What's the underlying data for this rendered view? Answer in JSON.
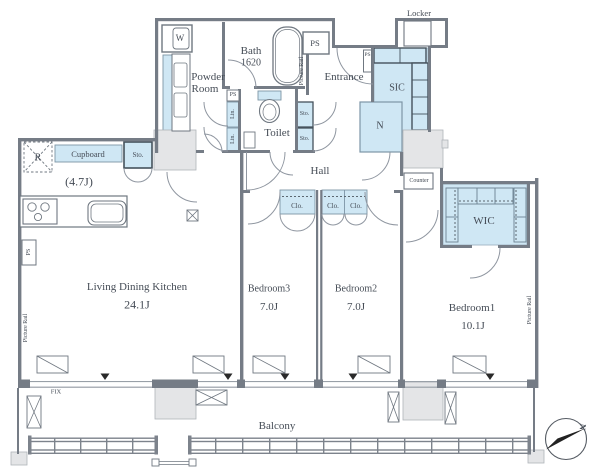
{
  "rooms": {
    "ldk": {
      "name": "Living Dining Kitchen",
      "size": "24.1J"
    },
    "kitchen_size": "(4.7J)",
    "bedroom1": {
      "name": "Bedroom1",
      "size": "10.1J"
    },
    "bedroom2": {
      "name": "Bedroom2",
      "size": "7.0J"
    },
    "bedroom3": {
      "name": "Bedroom3",
      "size": "7.0J"
    },
    "bath": {
      "name": "Bath",
      "size": "1620"
    },
    "powder_room": {
      "line1": "Powder",
      "line2": "Room"
    },
    "toilet": "Toilet",
    "entrance": "Entrance",
    "hall": "Hall",
    "balcony": "Balcony",
    "wic": "WIC",
    "sic": "SIC",
    "locker": "Locker",
    "counter": "Counter",
    "n_storage": "N"
  },
  "fixtures": {
    "washer": "W",
    "fridge": "R",
    "cupboard": "Cupboard",
    "storage": "Sto.",
    "linen": "Lin.",
    "closet": "Clo.",
    "ps": "PS",
    "fix": "FIX",
    "picture_rail": "Picture Rail",
    "compass_north": "N"
  },
  "colors": {
    "fixture_blue": "#cfe7f4",
    "wall_gray": "#757c86",
    "shaft_gray": "#e4e5e7",
    "text": "#454c56"
  }
}
